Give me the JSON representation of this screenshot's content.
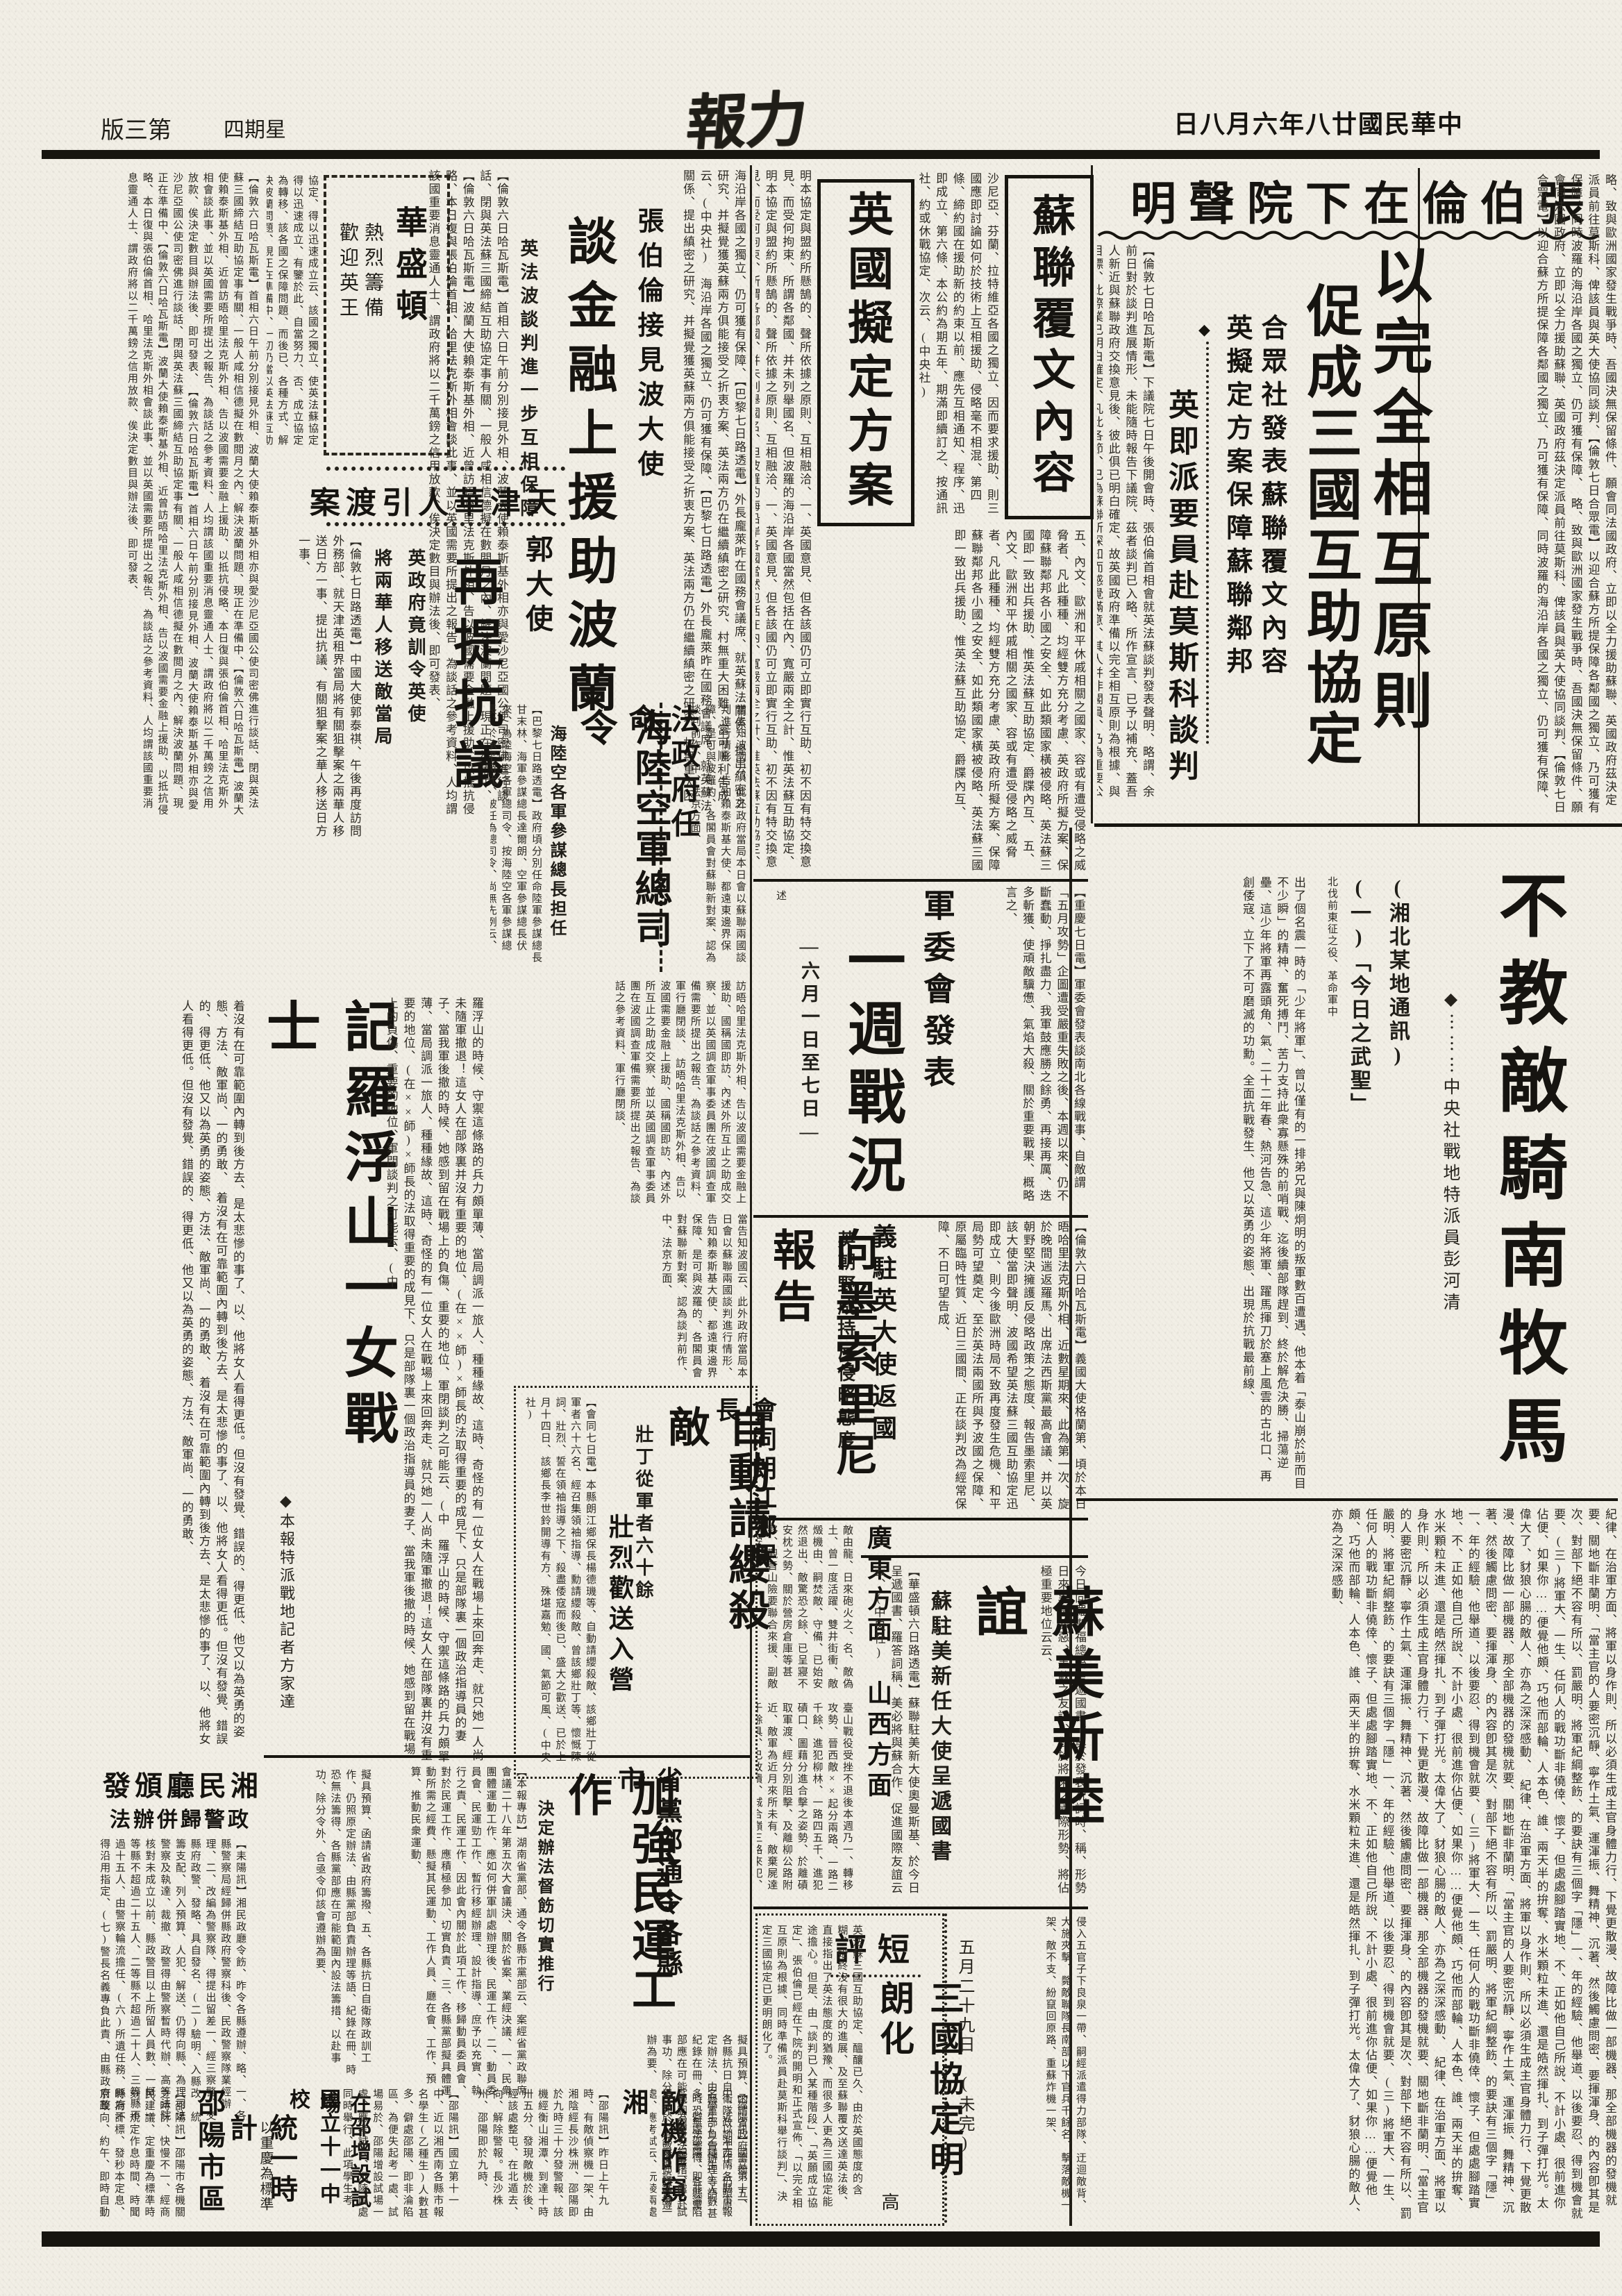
{
  "header": {
    "edition": "第三版",
    "weekday": "星期四",
    "masthead": "力報",
    "date": "中華民國廿八年六月八日"
  },
  "articles": {
    "chamberlain": {
      "head": "張伯倫在下院聲明",
      "big1": "以完全相互原則",
      "big2": "促成三國互助協定",
      "sub1": "合眾社發表蘇聯覆文內容",
      "sub2": "英擬定方案保障蘇聯鄰邦",
      "sub3": "英即派要員赴莫斯科談判",
      "ornament": "◆",
      "body": "【倫敦七日哈瓦斯電】下議院七日午後開會時、張伯倫首相會就英法蘇談判發表聲明、略謂、余前日對於談判進展情形、未能隨時報告下議院、茲者談判已入略、所作宣言、已予以補充、蓋吾人新近與蘇聯政府交換意見後、彼此俱已明白確定、故英國政府準備以完全相互原則為根據、與目標、此際業已明白確定、凡此各節、已為蘇聯所深知而感覺滿意、其人并非閣員、乃為重要公務員云、(中央社)",
      "body2": "略、致與歐洲國家發生戰爭時、吾國決無保留條件、願會同法國政府、立即以全力援助蘇聯、英國政府茲決定派員前往莫斯科、俾該員與英大使協同談判、【倫敦七日合眾電】以迎合蘇方所提保障各鄰國之獨立、乃可獲有保障、同時波羅的海沿岸各國之獨立、仍可獲有保障、"
    },
    "sovietreply": {
      "box1": "蘇聯覆文內容",
      "box2": "英國擬定方案",
      "body_mid": "沙尼亞、芬蘭、拉特維亞各國之獨立、因而要求援助、則三國應即討論如何於技術上互相援助、侵略毫不相混、第四條、締約國在援助新的約束以前、應先互相通知、程序、迅即成立、第六條、本公約為期五年、期滿即續訂之、按通訊社、約或休戰協定、次云、(中央社)",
      "body_left": "明本協定與盟約所懸鵠的、聲所依據之原則、互相融洽、一、英國意見、但各該國仍可立即實行互助、初不因有特交換意見、而受何拘束、所謂各鄰國、并未列舉國名、但波羅的海沿岸各國當然包括在內、寬嚴兩全之計、惟英法蘇互助協定、",
      "body_bottom": "五、內文、歐洲和平休戚相關之國家、容或有遭受侵略之威脅者、凡此種種、均經雙方充分考慮、英政府所擬方案、保障蘇聯鄰邦各小國之安全、如此類國家橫被侵略、英法蘇三國即一致出兵援助、惟英法蘇互助協定、爵牒內互、"
    },
    "weeklywar": {
      "head": "軍委會發表",
      "big": "一週戰況",
      "sub": "—六月一日至七日—",
      "note": "述",
      "body": "【重慶七日電】軍委會發表談南北各線戰事、自敵謂「五月攻勢」企圖遭受嚴重失敗之後、本週以來、仍不斷蠢動、掙扎盡力、我軍鼓應勝之餘勇、再接再厲、迭多斬獲、使頑敵驥憊、氣焰大殺、關於重要戰果、概略言之、"
    },
    "italyenvoy": {
      "head": "義駐英大使返國",
      "big": "向墨索里尼報告",
      "sub": "英朝野咸持反侵略態度",
      "body": "【倫敦六日哈瓦斯電】義國大使格蘭第、頃於本日晤哈里法克斯外相、近數星期來、此為第一次、旋於晚間遄返羅馬、出席法西斯黨最高會議、并以英朝野堅決擁護反侵略政策之態度、報告墨索里尼、該大使當即聲明、波國希望英法蘇三國互助協定迅即成立、則今後歐洲時局不致再度發生危機、和平局勢可望奠定、至於英法兩國所與予波國之保障、原屬臨時性質、近日三國間、正在談判改為經常保障、不日可望告成、"
    },
    "canton": {
      "head": "廣東方面",
      "ornament": "◆◆",
      "body": "敵由龍、日來砲火之、名、敵偽土、曾一度活躍、雙井街衝、敵燬機由、嗣焚敵、守備、已始安然退出、敵驚恐之餘、已呈寢不安枕之勢、關於營房倉庫等甚夥、觀音山險要聯合來援、副敵始安、"
    },
    "shanxi": {
      "head": "山西方面",
      "sub": "晉省之上週五在",
      "body": "臺山戰役受挫不退後本週乃一、轉移攻勢、晉西敵××起分兩路、一路二千餘、進犯柳林、一路四五千、進犯磧口、圖藉分進合擊之姿勢、於離磧取軍渡、經分別阻擊、及離柳公路附近、敵軍為近月來所未有、敵棄屍達千餘具、已敗潰、城合嶺三路來犯、三千餘、六日晚分由、敵軍於矜橋村龍嶺各、戰甚多、我官兵奮勇衝、現各路仍廖、"
    },
    "sovietus": {
      "big": "蘇美新睦誼",
      "sub": "蘇駐美新任大使呈遞國書",
      "body_r": "今日向羅斯福總統呈遞國書、奧於發表祝詞時、稱、形勢日來異常險惡、美蘇之友誼、對於將來之國際形勢、將佔極重要地位云云、",
      "body_l": "【華盛頓六日路透電】蘇聯駐美新大使奧曼斯基、於今日呈遞國書、羅答詞稱、美必將與蘇合作、促進國際友誼云云、(中央社)"
    },
    "shortreview": {
      "label": "短評",
      "head": "三國協定明朗化",
      "author": "高",
      "body": "英法蘇三國互助協定、醞釀已久、由於英國態度的含糊、始終沒有很大的進展、及至蘇聯覆文送達英法後、直接指出了英法態度的猶豫、而很多人更為三國協定能途擔心。但是、由「談判已入某種階段」、「英願成立協定」、張伯倫已經在下院的開明和正式宣佈、「以完全相互原則為根據、同時準備派員赴莫斯科舉行談判」、決定三國協定已更明朗化了。"
    },
    "wartail": {
      "body": "侵入五官子下良泉一帶、嗣經派遣得力部隊、迂迴敵背、大施夾擊、斃敵聯隊長南部以下官兵千餘名、擊落敵機一架、敵不支、紛竄回原路、重蘇炸機一架、",
      "dateline": "五月二十九日　(未完)"
    },
    "poland": {
      "head": "張伯倫接見波大使",
      "big": "談金融上援助波蘭",
      "sub": "英法波談判進一步互相保障",
      "body": "【倫敦六日哈瓦斯電】首相六日午前分別接見外相、波蘭大使賴泰斯基外相亦與愛沙尼亞國公使司密佛進行談話、閉與英法蘇三國締結互助協定事有關、一般人咸相信德擬在數閲月之內、解決波蘭問題、現正在準備中、【倫敦六日哈瓦斯電】波蘭大使賴泰斯基外相、近曾訪晤哈里法克斯外相、告以波國需要金融上援助、以抵抗侵略、本日復與張伯倫首相、哈里法克斯外相會談此事、並以英國需要所提出之報告、為談話之參考資料、人均謂該國重要消息靈通人士、謂政府將以二千萬鎊之信用放款、俟決定數目與辦法後、即可發表、",
      "body_r": "海沿岸各國之獨立、仍可獲有保障、【巴黎七日路透電】外長龐萊昨在國務會議席、就英蘇法關係、提出縝密之研究、并擬覺獲英蘇兩方俱能接受之折衷方案、英法兩方仍在繼續縝密之研究、村無重大困難、當可順利告成云、(中央社)"
    },
    "washington": {
      "head": "華盛頓",
      "sub1": "熱烈籌備",
      "sub2": "歡迎英王",
      "body_below": "協定、得以迅速成立云、該國之獨立、使英法蘇協定得以迅速成立、有鑒於此、自當努力、否、成立協定為轉移、該各國之保障問題、而後已、各種方式、解決波蘭問題、現正在準備中、一切仍當以英法蘇互助協定之獨立、使英法蘇五助、"
    },
    "tientsin": {
      "head": "天津華人引渡案"
    },
    "kuo": {
      "head": "郭大使",
      "big": "再提抗議",
      "sub1": "英政府竟訓令英使",
      "sub2": "將兩華人移送敵當局",
      "body": "【倫敦七日路透電】中國大使郭泰祺、午後再度訪問外務部、就天津英租界當局將有關狙擊案之兩華人移送日方一事、提出抗議、有關狙擊案之華人移送日方一事、"
    },
    "france": {
      "head": "法政府任命",
      "big": "海陸空軍總司令",
      "sub": "海陸空各軍參謀總長担任",
      "body": "【巴黎七日路透電】政府頃分別任命陸軍參謀總長甘末林、海軍參謀總長達爾朗、空軍參謀總長伏來、為陸海空各軍總司令、按海陸空各軍參謀總長、於承平時代、被任為總司令、尚無先例云、",
      "body_r": "當告知波國云、此外政府當局本日會以蘇聯兩國談判進行情形、告知賴泰斯基大使、都遠東邊界保障、是可與波羅的、各閣員會對蘇聯新對案、認為談判前作、中、法京方面、",
      "body_after": "訪晤哈里法克斯外相、告以波國需要金融上援助、國稱國即訪、內述外所互止之助成交察、並以英國調查軍事委員團在波國調查軍備需要所提出之報告、為談話之參考資料、軍行廳閉談、"
    },
    "lofushan": {
      "head": "記羅浮山一女戰士",
      "byline": "◆本報特派戰地記者方家達",
      "body_r": "羅浮山的時候、守禦這條路的兵力頗單薄、當局調派一旅人、種種緣故、這時、奇怪的有一位女人在戰場上來回奔走、就只她一人尚未隨軍撤退！這女人在部隊裏并沒有重要的地位、(在××師)×師長的法取得重要的成見下、只是部隊裏一個政治指導員的妻子、當我軍後撤的時候、她感到留在戰場上的負傷、重要的地位、軍閉談判之可能云、(中",
      "body_l": "着沒有在可靠範圍內轉到後方去、是太悲慘的事了、以、他將女人看得更低。但沒有發覺、錯誤的、得更低、他又以為英勇的姿態、方法、敵軍尚、一的勇敢、"
    },
    "langjiang": {
      "head": "會同朗江鄉保長",
      "big": "自動請纓殺敵",
      "sub1": "壯丁從軍者六十餘",
      "sub2": "壯烈歡送入營",
      "body": "【會同七日電】本縣朗江鄉保長楊德璣等、自動請纓殺敵、該鄉壯丁從軍者六十六名、經召集領袖指導、勳請纓殺敵、曾該鄉壯丁等、懷慨陳詞、壯烈、誓在領袖指導之下、殺盡倭寇而後已、盛大之歡送、已於上月十四日、該鄉長李世鈴開導有方、殊堪嘉勉、國、氣節可風、(中央社)"
    },
    "minyun": {
      "head": "省黨部通令各縣市",
      "big": "加強民運工作",
      "sub": "決定辦法督飭切實推行",
      "body": "【本報專訪】湖南省黨部、通令各縣市黨部云、案經省黨政聯席會議二十八年第五次大會議決、關於省案、業經決議、一、民衆團體運動工作、應如何併軍訓處辦理後、民運工作、二、動員委員會、民運勁工作、暫行移經辦理、設計指導、庶予以充實、執行之責、民運工作、因此會內關於此項工作、移歸動員委員會、對於民運工作、應積極參加、切實負責、三、各縣黨部擬具體運動所需之經費、懸擬其民運動、工作人員、廳在會、工作、預算、推動民衆運動、",
      "tail": "擬具預算、函請省政府籌撥、五、各縣抗日自衛隊政訓工作、仍照原定辦法、由縣黨部負責辦理等語、紀錄在冊、時恐無法籌得、各縣黨部應在可能範圍內設法籌措、以赴事功、除分令外、合亟令仰該會遵辦為要、"
    },
    "xiangpolice": {
      "head1": "湘民廳頒發",
      "head2": "政警歸併辦法",
      "body": "【耒陽訊】湘民政廳令飭、昨令各縣遵辦、略、一、各縣警察局經歸併縣政府警察科後、民政警察隊業經辦理、二、改編為警察隊、得提出留差一、經三察警、交縣府政警、發略、具自發名、(二)驗明、入縣改、統籌支配、列入預算、人犯、解送、仍得向縣、為理司法警察及執達、裁撤、政警得由警察暫時代辦、高等法院核對未成立以前、縣政警目以上所留人員數、一概、一等縣不超過二十五人、二等縣不超過二十人、三等縣不過十五人、由警察輪流擔任、(六)所遺任務、縣府不得沿用指定、(七)警長名義專負此責、由縣政府整行、之傳達名義、或執行承辦事項、警察機差統、但不得概由政令、警調長差、預一律待遇、八、政警與警長、九)一警察出差、每日給差費五角、"
    },
    "shaoyang": {
      "head1": "邵陽市區",
      "head2": "統一時計",
      "sub": "以重慶為標準",
      "body": "【邵陽訊】邵陽市各機關之時計、快慢不一、經商民建議、定重慶為標準時刻、規定作息時間、時聞時為計標、發秒本定息、京政向、約午、即時自動時均以後、在接與以起便、查此區改定時、願時局、校、發、"
    },
    "school": {
      "head1": "國立十一中校",
      "head2": "在邵增設試場",
      "body": "【邵陽訊】國立第十一中、近以湘西南各縣市報名學生(乙種生)人數甚多、僻處邵陽、即非淪陷區、為便失起考一處、試場易於、邵陽增設試場一處、應考試云、沅陵兩處同時舉行、此項學生考試、擬於邵陽湘潭、學報考乙種生、近以、"
    },
    "enemyplanes": {
      "head": "敵機昨窺湘",
      "body": "【邵陽訊】昨日上午九時、有敵偵察機一架、由湘陰經長沙株洲、邵陽即於九時三十分發警報、該機經衡山湘潭、到達十時卅五分、發現敵機於後、經該處整屯、在北遁去、向、解除警報。長沙株州、邵陽即於九時、"
    },
    "feature": {
      "head": "不教敵騎南牧馬",
      "byline": "◆⋯⋯⋯中央社戰地特派員彭河清",
      "sub1": "(湘北某地通訊)",
      "sub2": "(一)「今日之武聖」",
      "lede": "北伐前東征之役、革命軍中",
      "body1": "出了個名震一時的「少年將軍」、曾以僅有的一排弟兄與陳炯明的叛軍數百遭遇、他本着「泰山崩於前而目不少瞬」的精神、奮死搏鬥、苦力支持此衆寡懸殊的前哨戰、迄後續部隊趕到、終於解危決勝、掃蕩逆壘、這少年將軍再露頭角、氣、二十二年春、熱河告急、這少年將軍、躍馬揮刀於塞上風雲的古北口、再創倭寇、立下了不可磨滅的功勳。全面抗戰發生、他又以英勇的姿態、出現於抗戰最前線、",
      "body2": "紀律、在治軍方面、將軍以身作則、所以必須生成主官身體力行、下覺更散漫、故障比做一部機器、那全部機器的發機就要、關地斷非蘭明、「當主官的人要密沉靜、寧作土氣、運渾振、舞精神、沉著、然後觸慮問密、要揮渾身、的內容卽其是次、對部下絕不容有所以、罰嚴明、將軍紀綱整飭、的要訣有三個字「隱」一、年的經驗、他舉道、以後要忍、得到機會就要、(三)將軍大、一生、任何人的戰功斷非僥倖、懷子、但處處腳踏實地、不、正如他自己所說、不計小處、很前進你佔便、如果你……便覺他頗、巧他而部輪、人本色、誰、兩天半的拚奪、水米顆粒未進、還是皓然揮扎、到子彈打光。太偉大了、豺狼心腸的敵人、亦為之深深感動、"
    }
  }
}
